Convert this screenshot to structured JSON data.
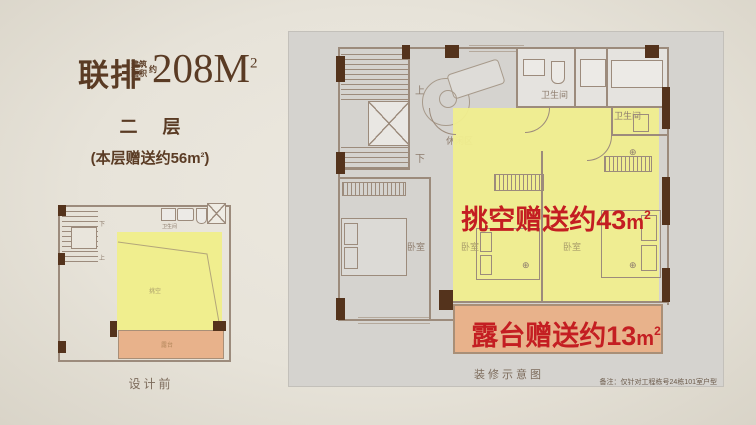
{
  "header": {
    "series": "联排",
    "area_small_top": "建筑",
    "area_small_bottom": "面积",
    "area_small_tail": "约",
    "area_value": "208M",
    "area_sup": "2",
    "floor_label": "二 层",
    "bonus_prefix": "(本层赠送约56",
    "bonus_unit": "m",
    "bonus_sup": "2",
    "bonus_suffix": ")"
  },
  "mini_plan": {
    "up_label": "上",
    "down_label": "下",
    "bath_label": "卫生间",
    "void_label": "挑空",
    "terrace_label": "露台",
    "caption": "设计前"
  },
  "main_plan": {
    "up_label": "上",
    "down_label": "下",
    "leisure_label": "休闲区",
    "bath_label_1": "卫生间",
    "bath_label_2": "卫生间",
    "bedroom_label_1": "卧室",
    "bedroom_label_2": "卧室",
    "bedroom_label_3": "卧室",
    "void_bonus_text": "挑空赠送约43",
    "void_bonus_unit": "m",
    "void_bonus_sup": "2",
    "terrace_bonus_text": "露台赠送约13",
    "terrace_bonus_unit": "m",
    "terrace_bonus_sup": "2",
    "caption": "装修示意图",
    "disclaimer": "备注：仅针对工程栋号24栋101室户型"
  },
  "colors": {
    "accent_red": "#c41e22",
    "highlight_yellow": "#f0ee8e",
    "terrace_orange": "#e8b28b",
    "wall_taupe": "#9c8b7c",
    "wood_dark": "#54331c",
    "title_brown": "#5a3b24",
    "panel_gray": "#d5d3cf"
  }
}
